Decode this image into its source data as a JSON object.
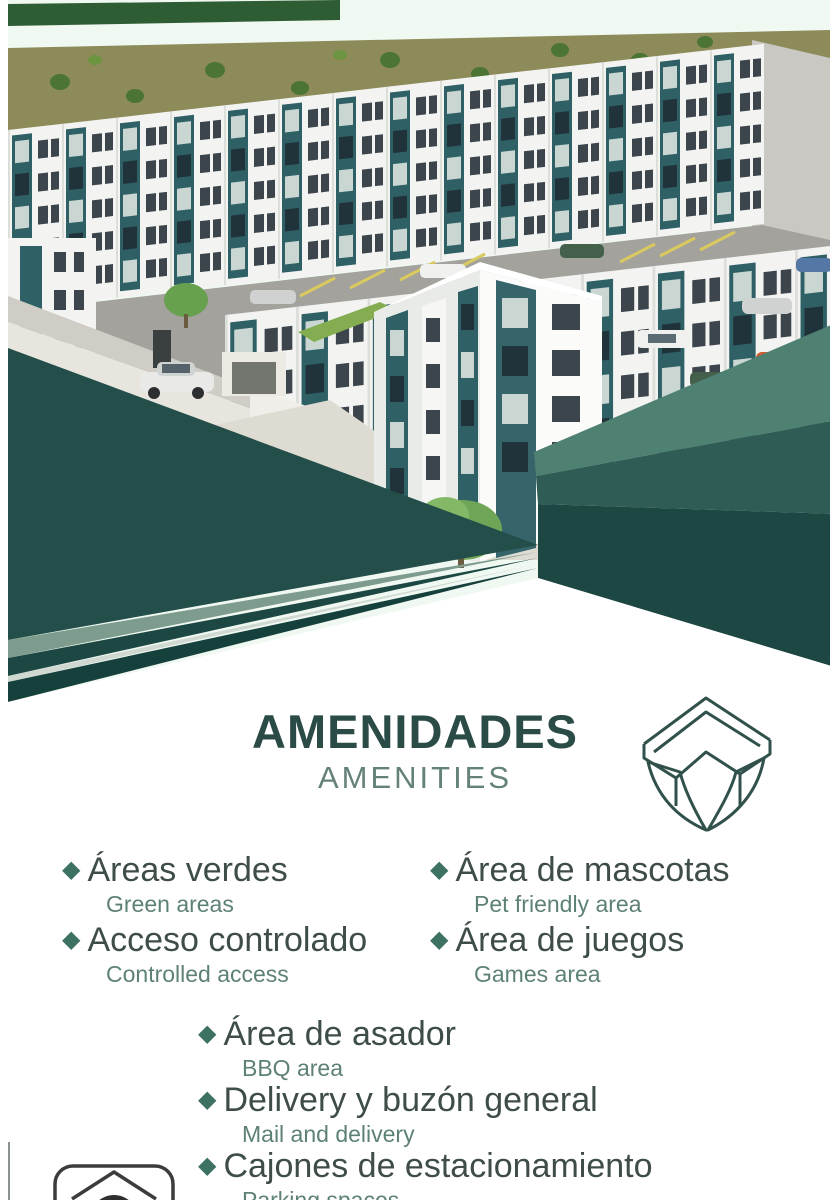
{
  "poster": {
    "title": "AMENIDADES",
    "subtitle": "AMENITIES"
  },
  "amenities": {
    "left": [
      {
        "name": "Áreas verdes",
        "translation": "Green areas"
      },
      {
        "name": "Acceso controlado",
        "translation": "Controlled access"
      }
    ],
    "right": [
      {
        "name": "Área de mascotas",
        "translation": "Pet friendly area"
      },
      {
        "name": "Área de juegos",
        "translation": "Games area"
      }
    ],
    "center": [
      {
        "name": "Área de asador",
        "translation": "BBQ area"
      },
      {
        "name": "Delivery y buzón general",
        "translation": "Mail and delivery"
      },
      {
        "name": "Cajones de estacionamiento",
        "translation": "Parking spaces"
      }
    ]
  },
  "icons": {
    "diamond_bullet": "◆"
  },
  "colors": {
    "triangle_dark": "#234E49",
    "triangle_darker": "#1D4742",
    "triangle_darkest": "#16403C",
    "triangle_medium": "#2F5D55",
    "triangle_sage": "#4F8173",
    "triangle_sage_light": "#7E9C8E",
    "triangle_pale": "#CFD9D2",
    "accent_teal": "#2E6066",
    "title_teal": "#2B4B47"
  }
}
